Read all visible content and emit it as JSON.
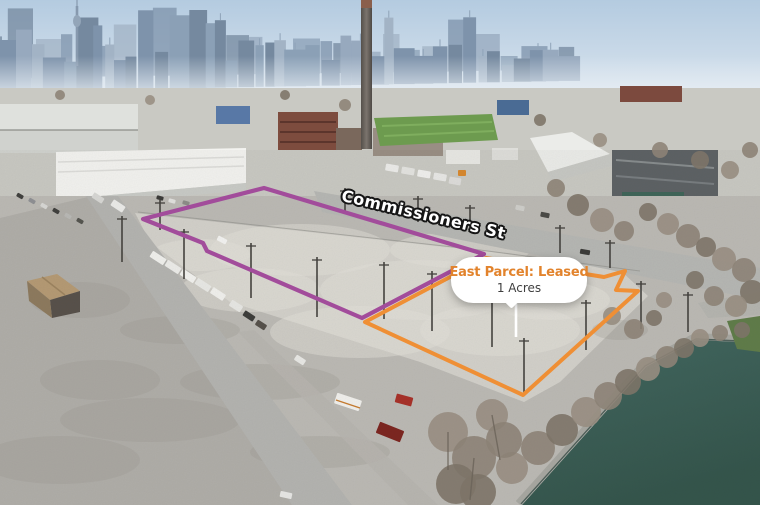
{
  "annotations": {
    "street_label": {
      "text": "Commissioners St",
      "fill": "#ffffff",
      "outline": "#161616"
    },
    "east_parcel_callout": {
      "title": "East Parcel: Leased",
      "subtitle": "1 Acres",
      "title_color": "#e2832c",
      "subtitle_color": "#3f3f3f",
      "bubble_color": "#ffffff"
    },
    "west_parcel": {
      "label": "west-parcel-outline",
      "color": "#a24c9b"
    },
    "east_parcel": {
      "label": "east-parcel-outline",
      "color": "#ef8f35"
    }
  },
  "scene_colors": {
    "water": "#3d6158",
    "sky": "#b9cfe2",
    "gravel": "#d3d1cb"
  }
}
